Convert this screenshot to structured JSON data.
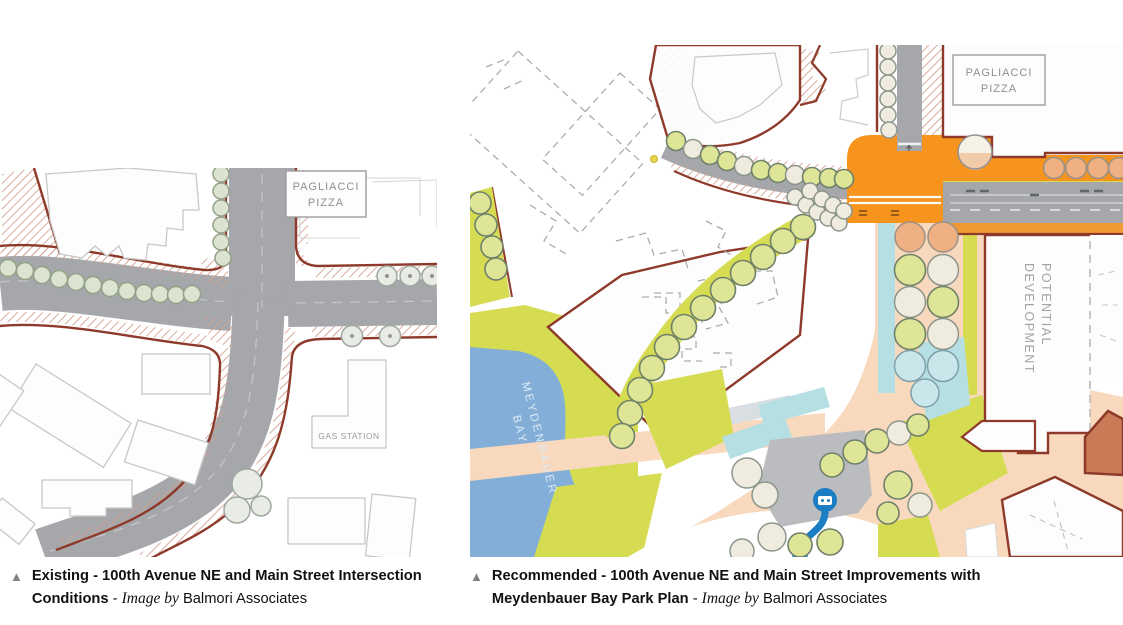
{
  "captions": {
    "left": {
      "marker": "▲",
      "title": "Existing - 100th Avenue NE and Main Street Intersection Conditions",
      "separator": " - ",
      "credit_prefix": "Image by",
      "credit_name": "Balmori Associates"
    },
    "right": {
      "marker": "▲",
      "title": "Recommended - 100th Avenue NE and Main Street Improvements with Meydenbauer Bay Park Plan",
      "separator": " - ",
      "credit_prefix": "Image by",
      "credit_name": "Balmori Associates"
    }
  },
  "plan_labels": {
    "left": {
      "pagliacci_line1": "PAGLIACCI",
      "pagliacci_line2": "PIZZA",
      "gas_station": "GAS STATION"
    },
    "right": {
      "pagliacci_line1": "PAGLIACCI",
      "pagliacci_line2": "PIZZA",
      "potential_line1": "POTENTIAL",
      "potential_line2": "DEVELOPMENT",
      "bay_line1": "MEYDENBAUER",
      "bay_line2": "BAY"
    }
  },
  "colors": {
    "curb_red": "#8E3A2B",
    "road_gray": "#A5A7AB",
    "intersection_orange": "#F7941D",
    "plaza_peach": "#F8D9BE",
    "park_green": "#D5DC52",
    "bay_blue": "#82AED8",
    "water_feature_cyan": "#B5DFE2",
    "feature_blue": "#1B7EC4",
    "tree_green": "#DFE597",
    "tree_cream": "#F0EBDF",
    "tree_orange": "#EFB183",
    "caption_marker_gray": "#7E8082"
  }
}
